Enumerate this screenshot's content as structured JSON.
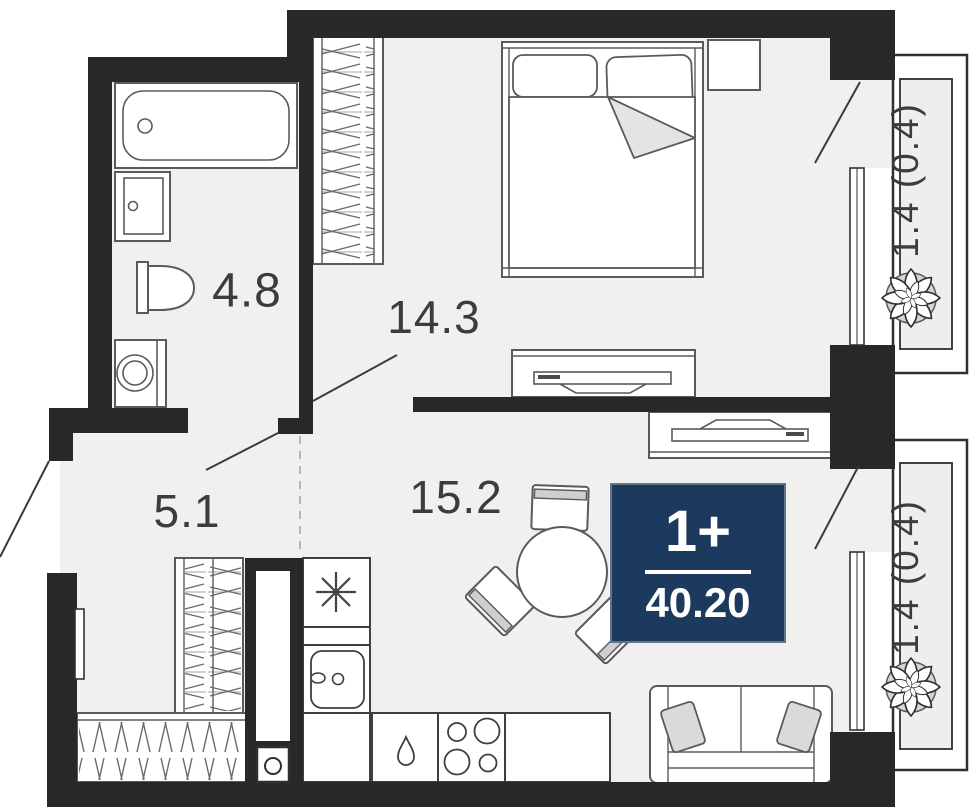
{
  "floorplan": {
    "unit_badge": {
      "type": "1+",
      "area": "40.20"
    },
    "rooms": {
      "bathroom": {
        "area": "4.8"
      },
      "bedroom": {
        "area": "14.3"
      },
      "hallway": {
        "area": "5.1"
      },
      "kitchen_living": {
        "area": "15.2"
      },
      "balcony_top": {
        "area": "1.4 (0.4)"
      },
      "balcony_bottom": {
        "area": "1.4 (0.4)"
      }
    },
    "colors": {
      "wall": "#282828",
      "floor": "#f0f1ef",
      "balcony_floor": "#edefee",
      "badge_bg": "#1b3a5e",
      "badge_text": "#ffffff",
      "label_text": "#3c3c3c",
      "furniture_line": "#5a5a5a",
      "accent_fill": "#d9dbda"
    }
  }
}
